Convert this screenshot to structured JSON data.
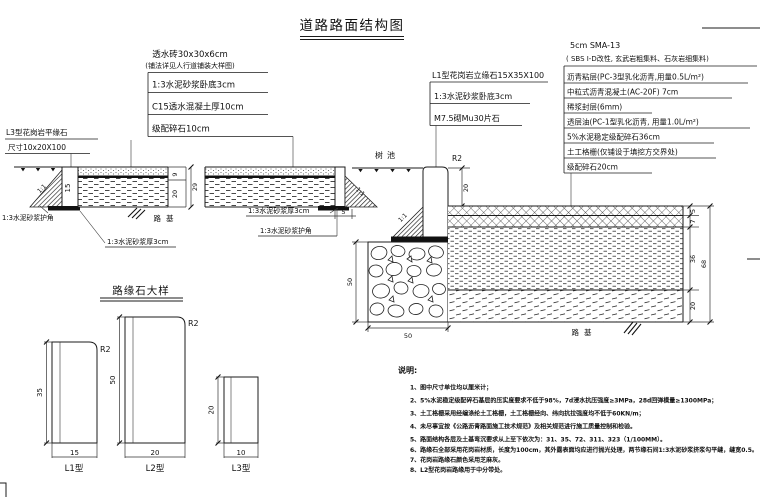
{
  "title": "道路路面结构图",
  "annotations": {
    "sidewalk": {
      "header1": "透水砖30x30x6cm",
      "header2": "(铺法详见人行道铺装大样图)",
      "rows": [
        "1:3水泥砂浆卧底3cm",
        "C15透水混凝土厚10cm",
        "级配碎石10cm"
      ]
    },
    "curb": {
      "header": "L1型花岗岩立缘石15X35X100",
      "rows": [
        "1:3水泥砂浆卧底3cm",
        "M7.5砌Mu30片石"
      ]
    },
    "road": {
      "header1": "5cm SMA-13",
      "header2": "( SBS I-D改性, 玄武岩粗集料、石灰岩细集料)",
      "rows": [
        "沥青粘层(PC-3型乳化沥青,用量0.5L/m²)",
        "中粒式沥青混凝土(AC-20F) 7cm",
        "稀浆封层(6mm)",
        "透层油(PC-1型乳化沥青, 用量1.0L/m²)",
        "5%水泥稳定级配碎石36cm",
        "土工格栅(仅铺设于填挖方交界处)",
        "级配碎石20cm"
      ]
    },
    "flat_curb": {
      "line1": "L3型花岗岩平缘石",
      "line2": "尺寸10x20X100"
    },
    "mortar_bed": "1:3水泥砂浆厚3cm",
    "mortar_corner": "1:3水泥砂浆护角"
  },
  "labels": {
    "tree_pit": "树池",
    "roadbed": "路基",
    "slope_ratio": "1:1",
    "fillet_radius": "R2"
  },
  "dims": {
    "sidewalk_top": "9",
    "sidewalk_base": "20",
    "sidewalk_total": "29",
    "left_curb": "15",
    "tree_edge": "5",
    "curb_reveal": "20",
    "road_layers": [
      "5",
      "7",
      "36",
      "20"
    ],
    "road_total": "68",
    "stone_height": "50",
    "stone_width": "50"
  },
  "curb_detail": {
    "title": "路缘石大样",
    "items": [
      {
        "label": "L1型",
        "w": "15",
        "h": "35",
        "r": "R2"
      },
      {
        "label": "L2型",
        "w": "20",
        "h": "50",
        "r": "R2"
      },
      {
        "label": "L3型",
        "w": "10",
        "h": "20",
        "r": ""
      }
    ]
  },
  "notes": {
    "heading": "说明:",
    "items": [
      "1、图中尺寸单位均以厘米计；",
      "2、5%水泥稳定级配碎石基层的压实度要求不低于98%，7d浸水抗压强度≥3MPa，28d回弹模量≥1300MPa；",
      "3、土工格栅采用经编涤纶土工格栅，土工格栅经向、纬向抗拉强度均不低于60KN/m；",
      "4、未尽事宜按《公路沥青路面施工技术规范》及相关规范进行施工质量控制和检验。",
      "5、路面结构各层及土基弯沉要求从上至下依次为：31、35、72、311、323（1/100MM）。",
      "6、路缘石全部采用花岗岩材质，长度为100cm，其外露表面均应进行抛光处理，两节缘石间1:3水泥砂浆挤浆勾平缝，缝宽0.5。",
      "7、花岗岩路缘石颜色采用芝麻灰。",
      "8、L2型花岗岩路缘用于中分带处。"
    ]
  }
}
